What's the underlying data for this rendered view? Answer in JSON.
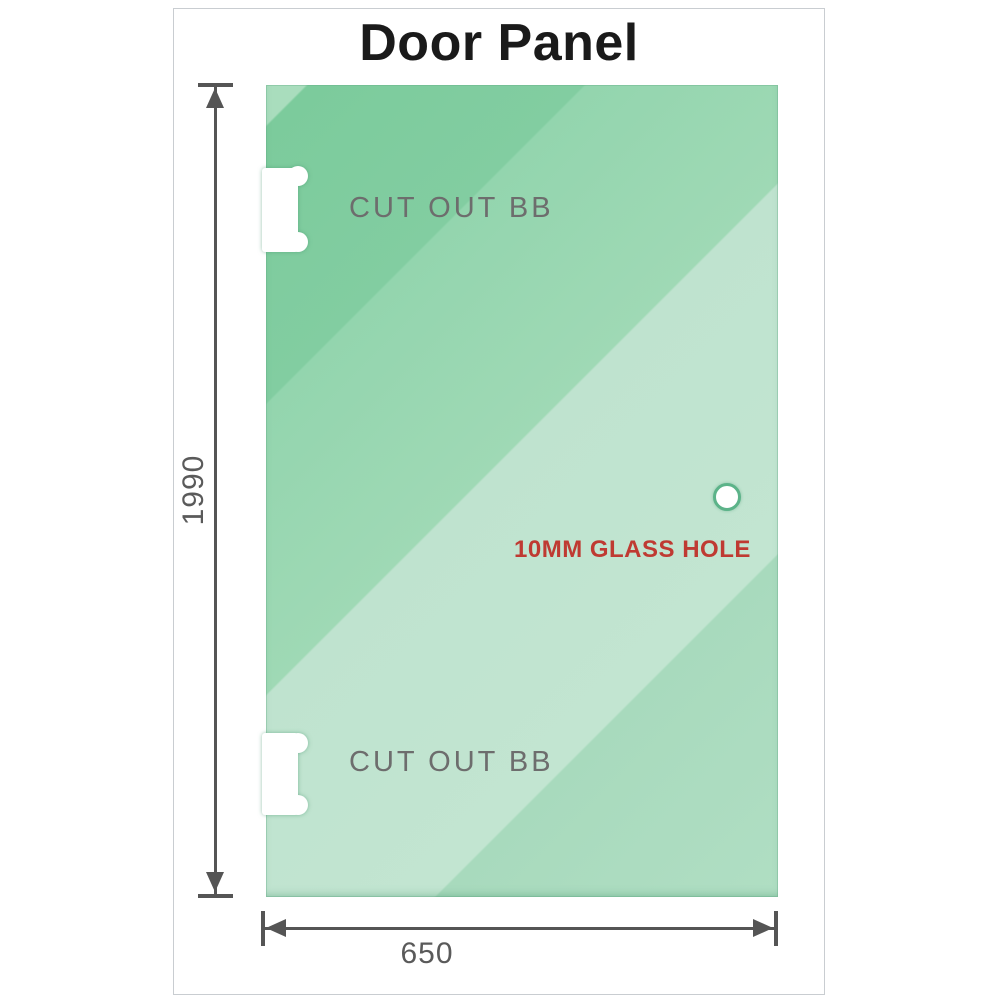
{
  "header": {
    "title": "Door Panel"
  },
  "diagram": {
    "cutout_top_label": "CUT OUT BB",
    "cutout_bottom_label": "CUT OUT BB",
    "hole_label": "10MM GLASS HOLE",
    "height_dim": "1990",
    "width_dim": "650",
    "colors": {
      "glass_dark": "#7ccb9c",
      "glass_mid": "#93d5ae",
      "glass_light": "#bfe3cf",
      "hole_ring": "#5cb389",
      "dimension": "#555555",
      "dim_text": "#5a5a5a",
      "cutout_text": "#6d6d6d",
      "hole_text": "#bf3a32",
      "frame_border": "#c9cdd1",
      "title_text": "#1a1a1a"
    }
  }
}
